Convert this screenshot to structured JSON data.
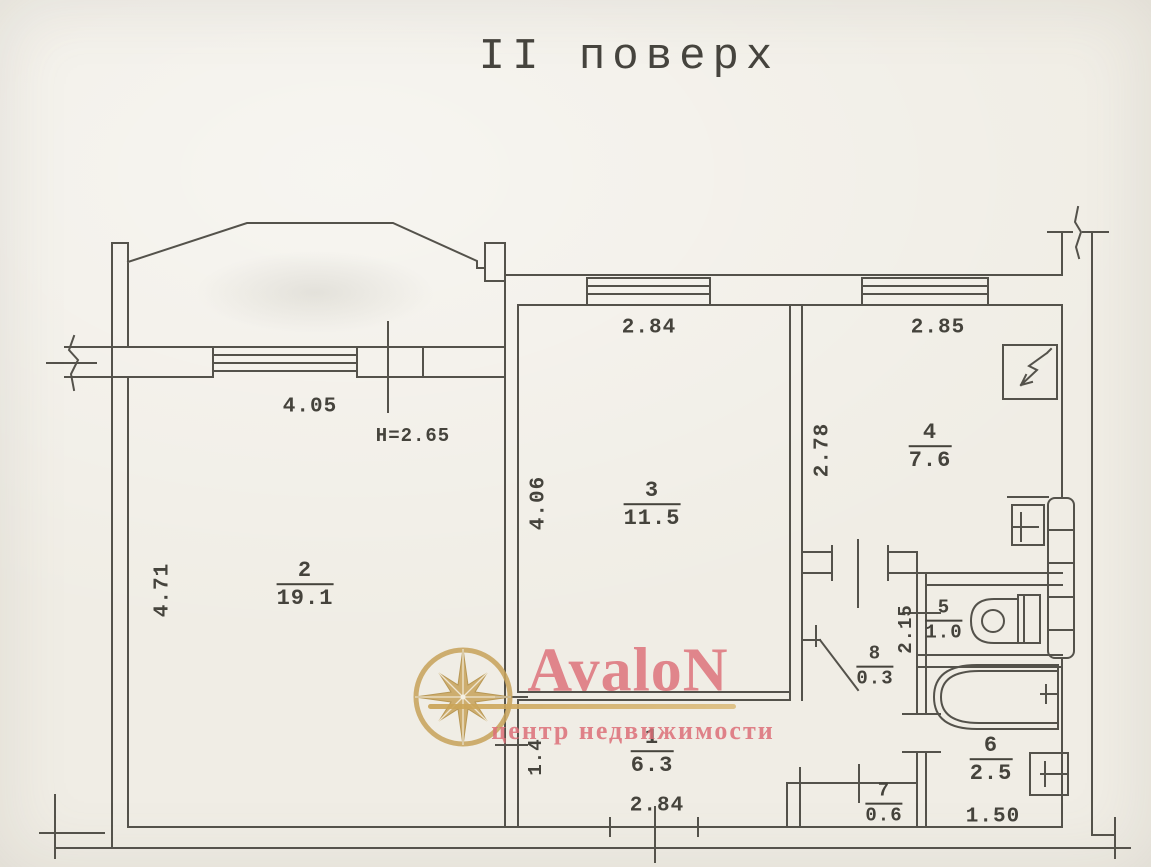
{
  "title": "II поверх",
  "rooms": {
    "r1": {
      "number": "1",
      "area": "6.3"
    },
    "r2": {
      "number": "2",
      "area": "19.1"
    },
    "r3": {
      "number": "3",
      "area": "11.5"
    },
    "r4": {
      "number": "4",
      "area": "7.6"
    },
    "r5": {
      "number": "5",
      "area": "1.0"
    },
    "r6": {
      "number": "6",
      "area": "2.5"
    },
    "r7": {
      "number": "7",
      "area": "0.6"
    },
    "r8": {
      "number": "8",
      "area": "0.3"
    }
  },
  "dimensions": {
    "room2_width": "4.05",
    "ceiling_height": "H=2.65",
    "room2_depth": "4.71",
    "room3_width": "2.84",
    "room3_depth": "4.06",
    "room4_width": "2.85",
    "room4_depth": "2.78",
    "wc_depth": "2.15",
    "hall_left_wall": "1.4",
    "hall_width": "2.84",
    "bath_width": "1.50"
  },
  "watermark": {
    "brand": "AvaloN",
    "tagline": "центр недвижимости"
  },
  "colors": {
    "paper": "#f0ede5",
    "ink": "#54524b",
    "brand_pink": "#dd6f78",
    "brand_gold": "#c9a55e"
  }
}
